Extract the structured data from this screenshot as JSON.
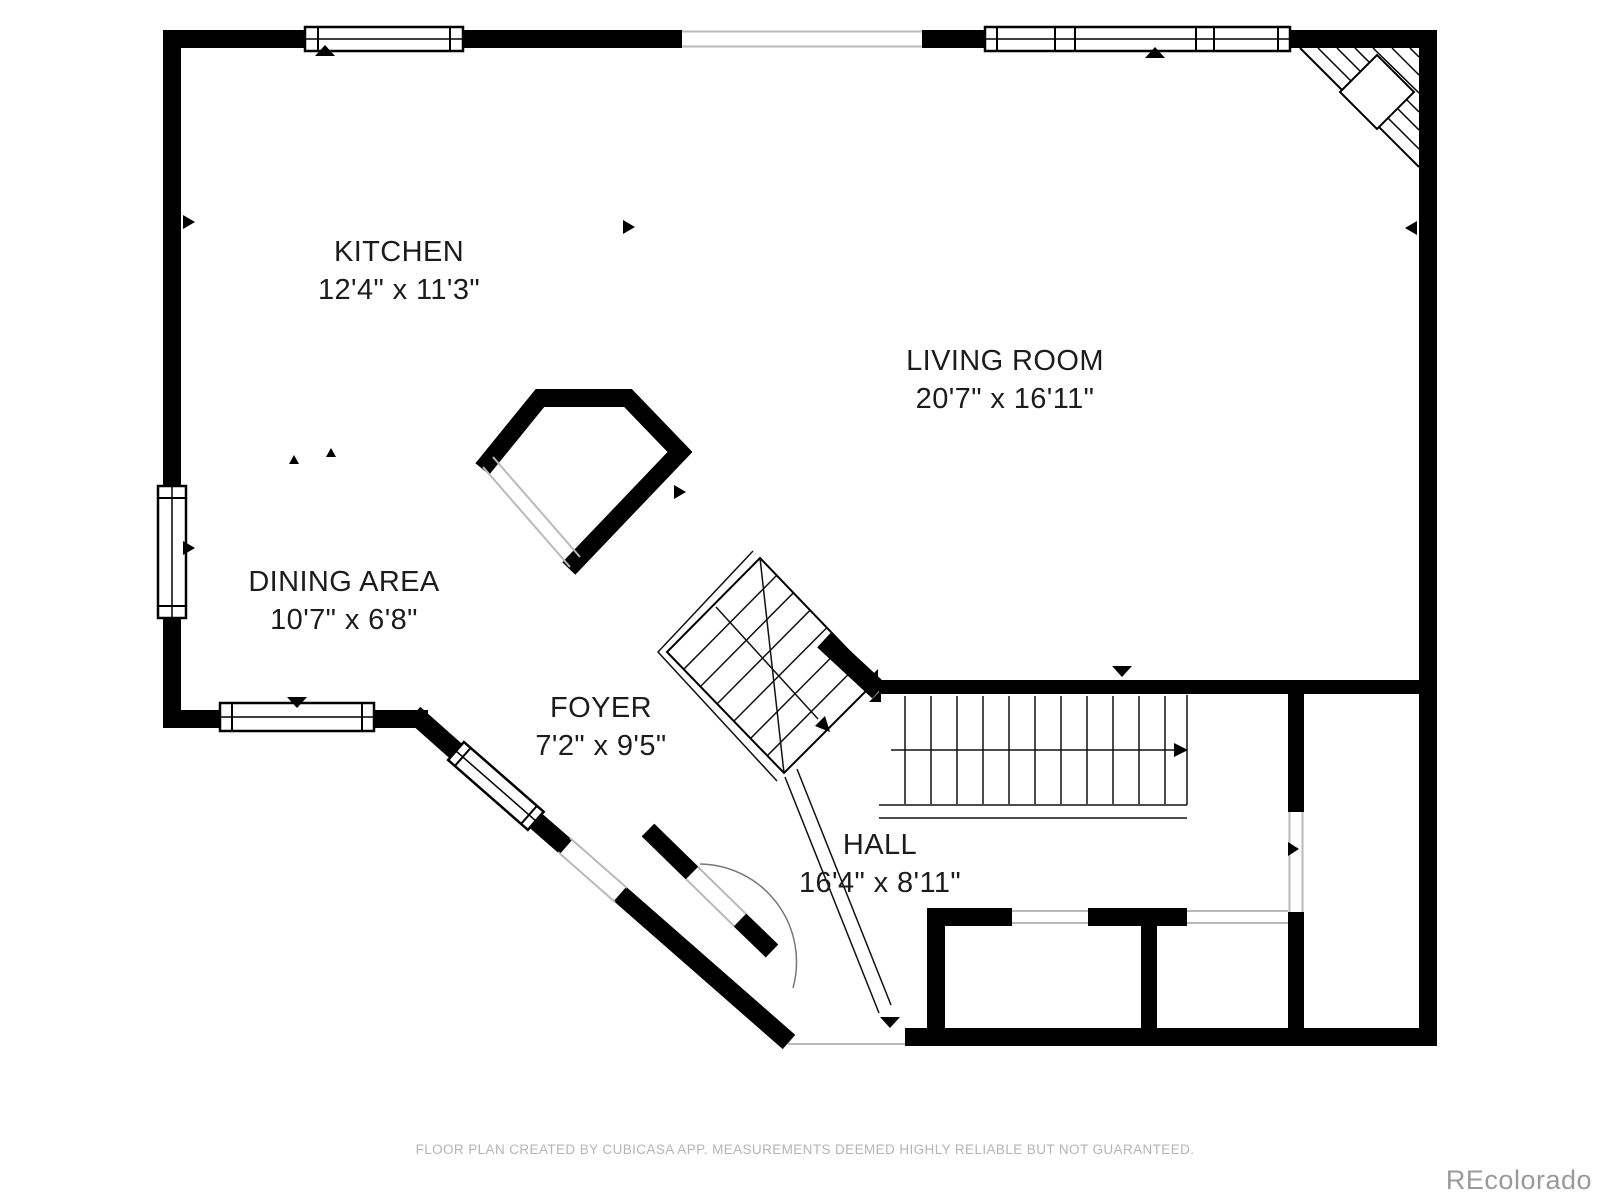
{
  "plan": {
    "rooms": [
      {
        "name": "KITCHEN",
        "dims": "12'4\" x 11'3\""
      },
      {
        "name": "LIVING ROOM",
        "dims": "20'7\" x 16'11\""
      },
      {
        "name": "DINING AREA",
        "dims": "10'7\" x 6'8\""
      },
      {
        "name": "FOYER",
        "dims": "7'2\" x 9'5\""
      },
      {
        "name": "HALL",
        "dims": "16'4\" x 8'11\""
      }
    ],
    "icons": {
      "stairs": "staircase-with-down-arrows",
      "fireplace": "corner-fireplace-hatch",
      "windows": "double-line-window",
      "door_markers": "triangle-door-marker",
      "entry_door": "door-swing-arc"
    },
    "colors": {
      "wall": "#000000",
      "thin_line": "#111111",
      "opening": "#b9b9b9",
      "label": "#1c1c1c",
      "footer": "#b4b4b4",
      "watermark": "#9a9a9a",
      "background": "#ffffff"
    }
  },
  "footer": {
    "disclaimer": "FLOOR PLAN CREATED BY CUBICASA APP. MEASUREMENTS DEEMED HIGHLY RELIABLE BUT NOT GUARANTEED."
  },
  "watermark": {
    "text": "REcolorado"
  }
}
